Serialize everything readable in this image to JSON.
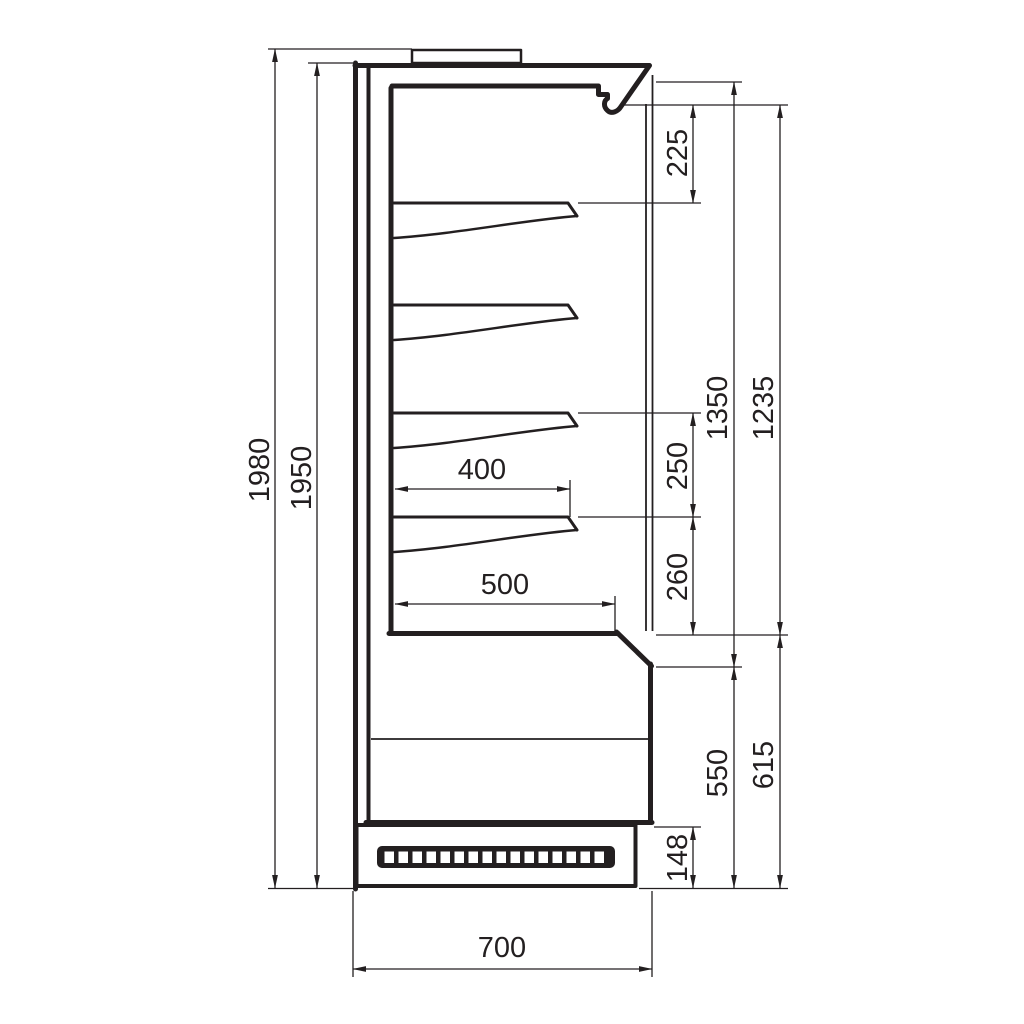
{
  "page": {
    "background": "#ffffff",
    "line_color": "#231f20"
  },
  "drawing": {
    "kind": "technical-dimension-drawing",
    "subject": "refrigerated wall display cabinet - side cross section",
    "shelf_count": 4,
    "grille_slot_count": 16,
    "dimensions": {
      "overall_height": "1980",
      "case_height": "1950",
      "canopy_to_first_shelf": "225",
      "interior_front_height": "1350",
      "shelf_zone_height": "1235",
      "shelf_spacing_upper": "250",
      "shelf_spacing_lower": "260",
      "shelf_depth": "400",
      "bottom_deck_depth": "500",
      "lower_front_height": "550",
      "lower_section_height": "615",
      "plinth_height": "148",
      "overall_depth": "700"
    }
  }
}
